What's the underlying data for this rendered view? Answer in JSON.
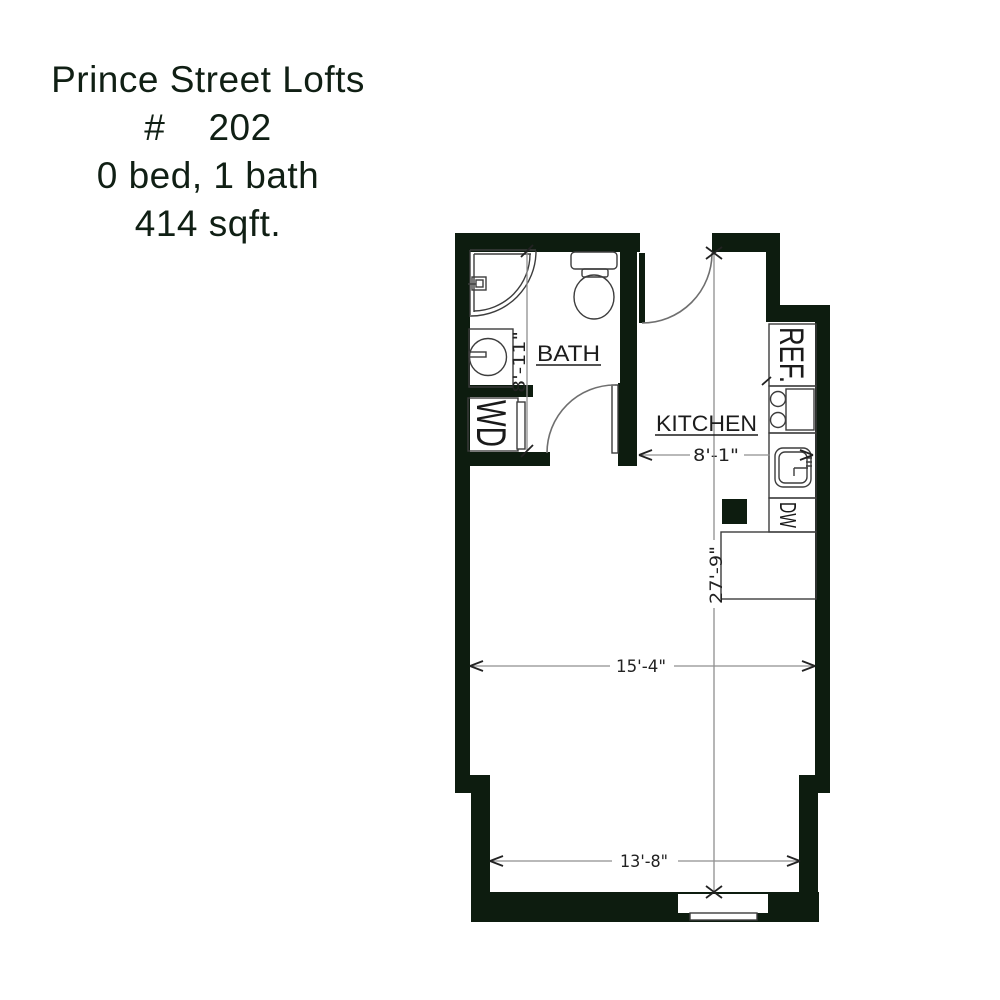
{
  "title": {
    "lines": [
      "Prince Street Lofts",
      "#    202",
      "0 bed, 1 bath",
      "414 sqft."
    ]
  },
  "plan": {
    "rooms": {
      "bath": "BATH",
      "kitchen": "KITCHEN"
    },
    "appliances": {
      "refrigerator": "REF.",
      "washer_dryer": "WD",
      "dishwasher": "DW"
    },
    "dimensions": {
      "bath_depth": "8'-11\"",
      "kitchen_width": "8'-1\"",
      "unit_length": "27'-9\"",
      "living_width": "15'-4\"",
      "lower_width": "13'-8\""
    }
  },
  "colors": {
    "wall_ink": "#0d1c0f",
    "fixture_line": "#3d3d3d",
    "dimension_line": "#8f8f8f",
    "text_ink": "#101f14",
    "background": "#ffffff"
  }
}
